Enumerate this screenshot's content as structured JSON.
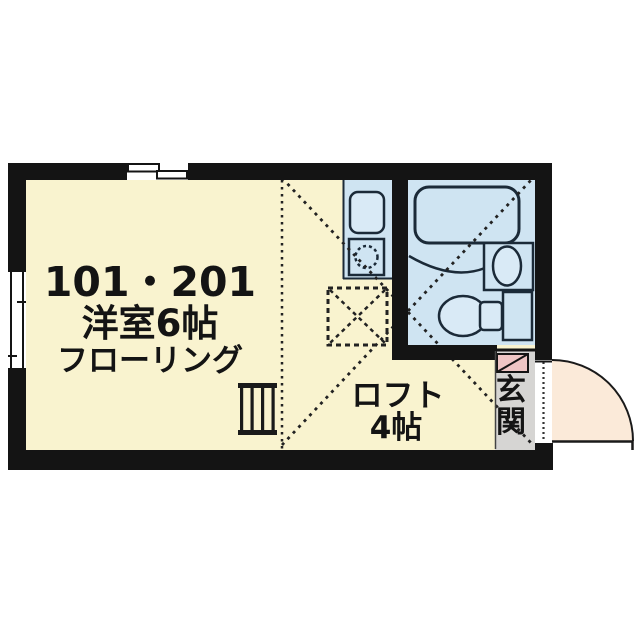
{
  "floor_plan": {
    "unit_numbers": "101・201",
    "main_room": {
      "label": "洋室6帖",
      "flooring_label": "フローリング",
      "size_jo": 6
    },
    "loft": {
      "label": "ロフト",
      "size_label": "4帖",
      "size_jo": 4
    },
    "entrance": {
      "label": "玄関",
      "char1": "玄",
      "char2": "関"
    },
    "fixtures": [
      "bathtub",
      "washbasin",
      "toilet",
      "kitchen-sink",
      "gas-stove",
      "loft-ladder",
      "loft-hatch",
      "entry-door",
      "shoe-cabinet",
      "window-top",
      "window-left"
    ],
    "colors": {
      "wall": "#141414",
      "room_floor": "#f9f3cf",
      "wet_area_floor": "#cfe4f2",
      "fixture_fill": "#d9eaf6",
      "entrance_floor": "#d6d5d3",
      "door_swing": "#fbead9",
      "shoe_cabinet": "#eec5c4"
    }
  }
}
